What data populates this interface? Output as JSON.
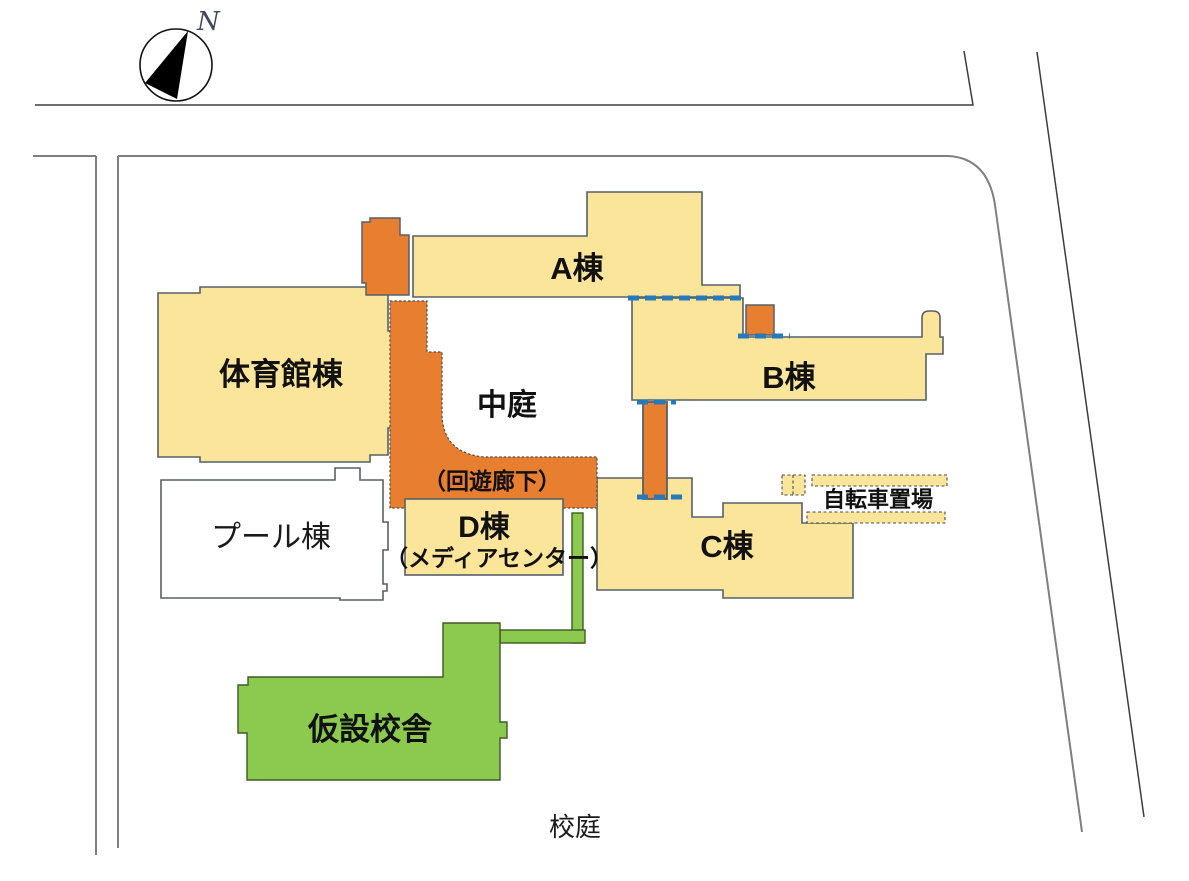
{
  "map_title": "school-site-plan",
  "compass": {
    "north_label": "N"
  },
  "areas": {
    "gym": {
      "label": "体育館棟"
    },
    "building_a": {
      "label": "A棟"
    },
    "building_b": {
      "label": "B棟"
    },
    "building_c": {
      "label": "C棟"
    },
    "building_d": {
      "label": "D棟",
      "sublabel": "（メディアセンター）"
    },
    "pool": {
      "label": "プール棟"
    },
    "courtyard": {
      "label": "中庭"
    },
    "corridor": {
      "label": "（回遊廊下）"
    },
    "temporary_building": {
      "label": "仮設校舎"
    },
    "bicycle_parking": {
      "label": "自転車置場"
    },
    "schoolyard": {
      "label": "校庭"
    }
  },
  "colors": {
    "building_cream": "#FBE59B",
    "walkway_orange": "#E87E30",
    "temporary_green": "#8CC94F",
    "pool_white": "#FFFFFF",
    "connection_blue": "#2779BE",
    "building_outline": "#566068",
    "boundary_gray": "#7F7F7F",
    "road_line": "#3D3D3D"
  }
}
